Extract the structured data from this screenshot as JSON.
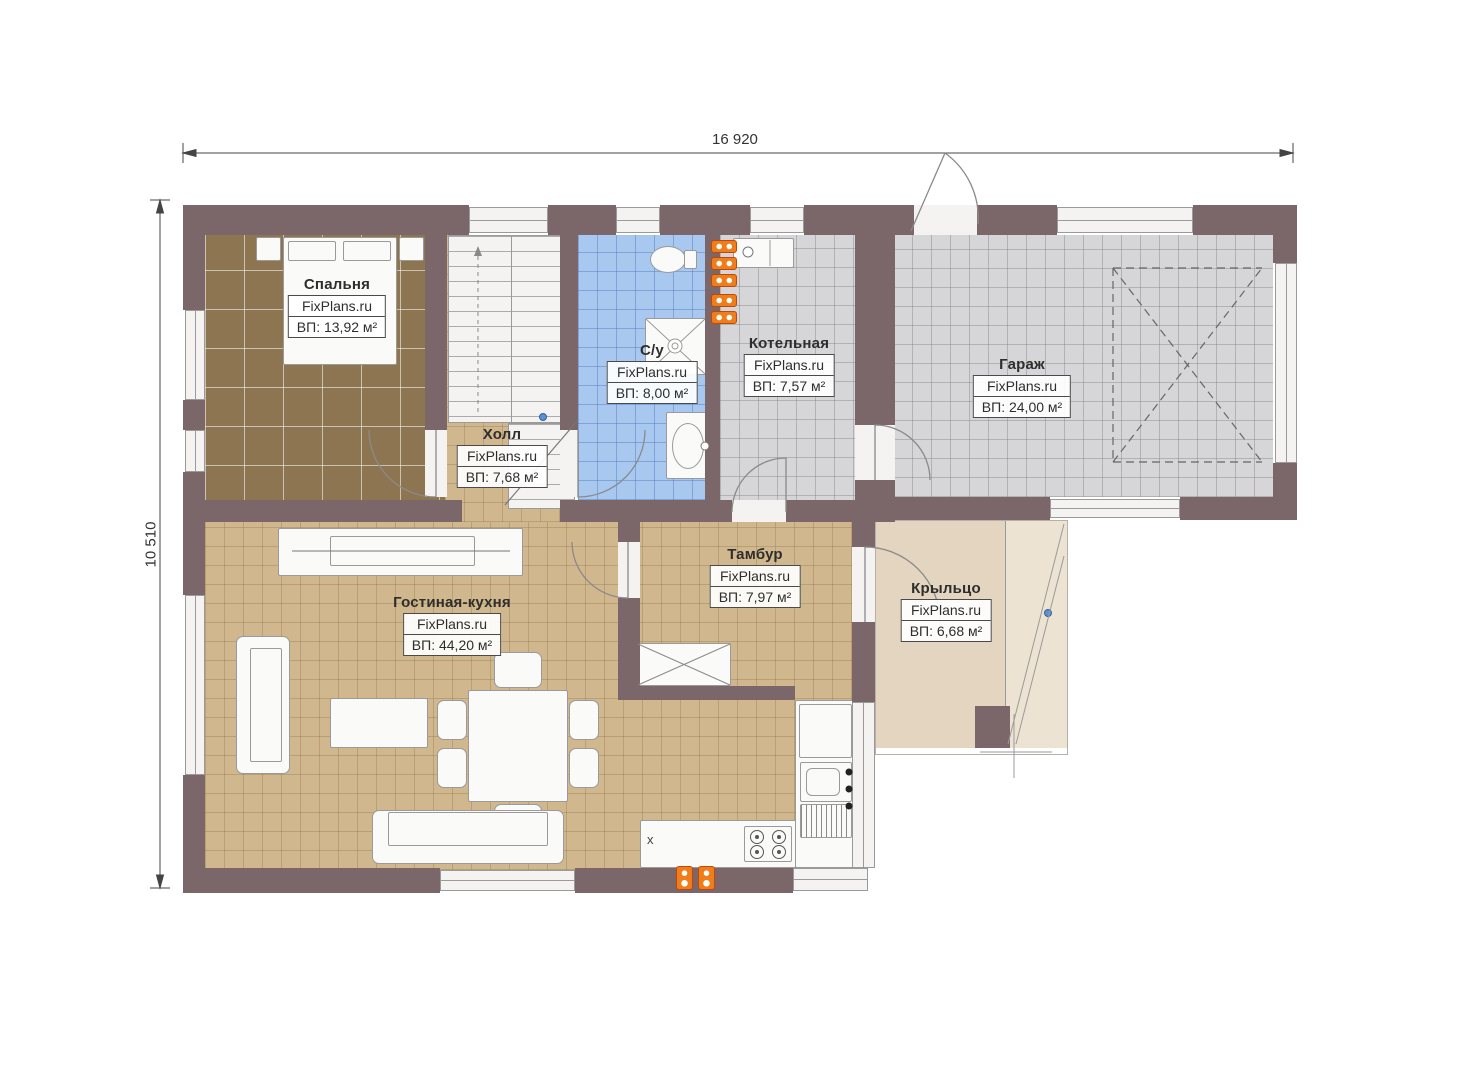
{
  "brand": "FixPlans.ru",
  "dimensions": {
    "top": "16 920",
    "left": "10 510"
  },
  "rooms": {
    "bedroom": {
      "name": "Спальня",
      "area": "ВП: 13,92 м²"
    },
    "hall": {
      "name": "Холл",
      "area": "ВП: 7,68 м²"
    },
    "bathroom": {
      "name": "С/у",
      "area": "ВП: 8,00 м²"
    },
    "boiler": {
      "name": "Котельная",
      "area": "ВП: 7,57 м²"
    },
    "garage": {
      "name": "Гараж",
      "area": "ВП: 24,00 м²"
    },
    "vestibule": {
      "name": "Тамбур",
      "area": "ВП: 7,97 м²"
    },
    "living": {
      "name": "Гостиная-кухня",
      "area": "ВП: 44,20 м²"
    },
    "porch": {
      "name": "Крыльцо",
      "area": "ВП: 6,68 м²"
    }
  },
  "marks": {
    "kitchen_x": "x"
  },
  "colors": {
    "wall": "#7b6669",
    "floor_bedroom": "#8d7552",
    "floor_tan": "#d0b78d",
    "floor_wet": "#a8c8f0",
    "floor_gray": "#d6d5d7",
    "floor_porch": "#e3d5bf",
    "radiator": "#ef7d1a"
  }
}
